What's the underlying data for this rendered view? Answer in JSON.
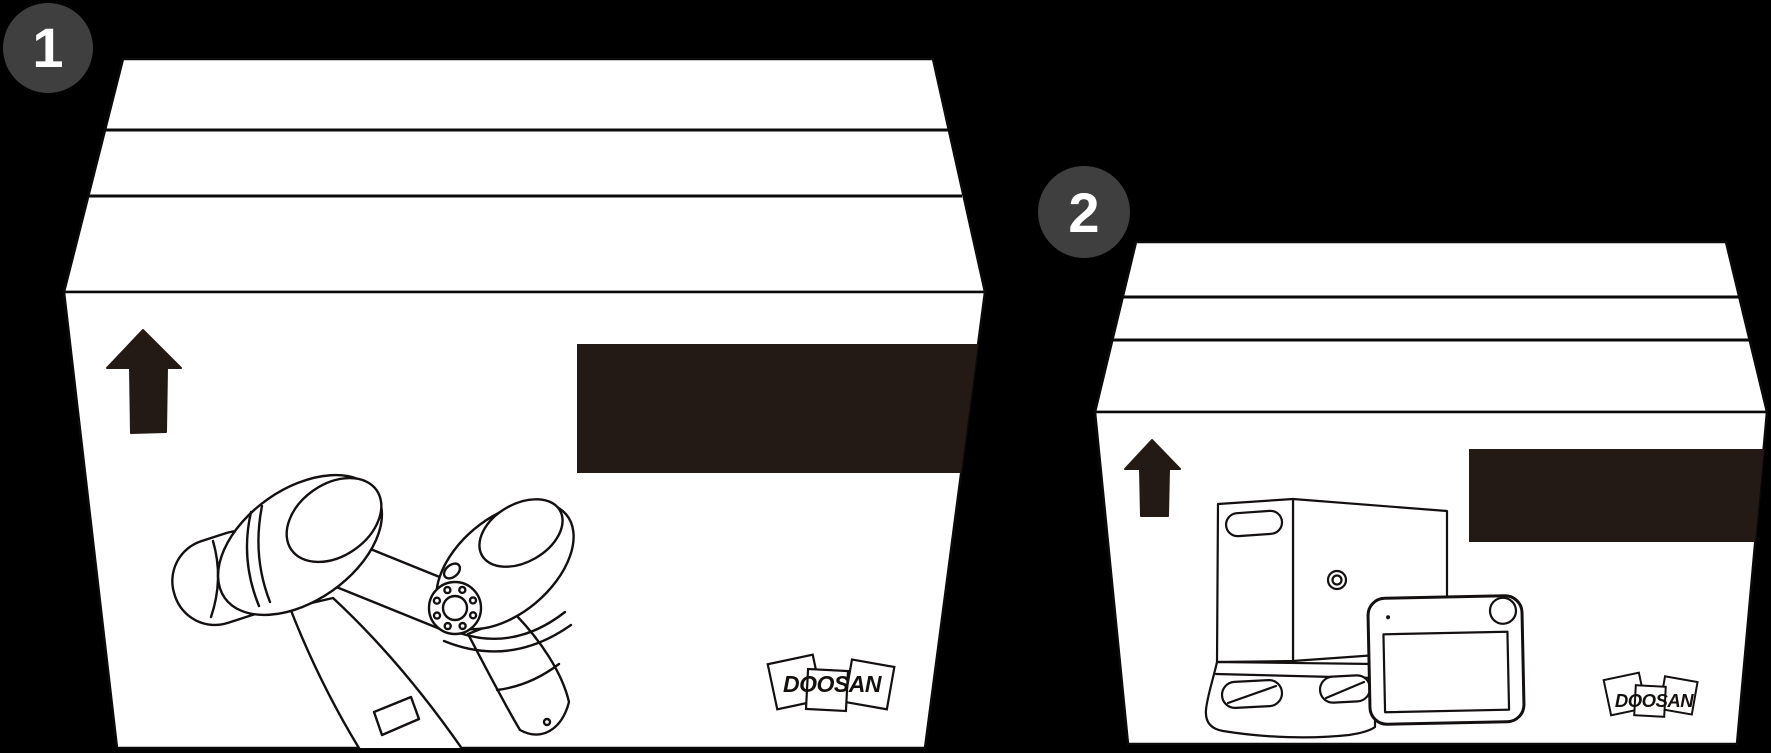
{
  "canvas": {
    "width": 1771,
    "height": 753,
    "background": "#000000"
  },
  "palette": {
    "box_fill": "#ffffff",
    "line": "#141010",
    "accent_dark": "#241a15",
    "badge_gray": "#3f3f3f",
    "badge_text": "#ffffff"
  },
  "steps": [
    {
      "badge": "1",
      "brand": "DOOSAN",
      "orientation_icon": "this-side-up-arrow-icon",
      "label_plate": "blank-dark-shipping-label",
      "contents_icon": "robot-manipulator-line-art"
    },
    {
      "badge": "2",
      "brand": "DOOSAN",
      "orientation_icon": "this-side-up-arrow-icon",
      "label_plate": "blank-dark-shipping-label",
      "contents_icon": "controller-and-teach-pendant-line-art"
    }
  ]
}
